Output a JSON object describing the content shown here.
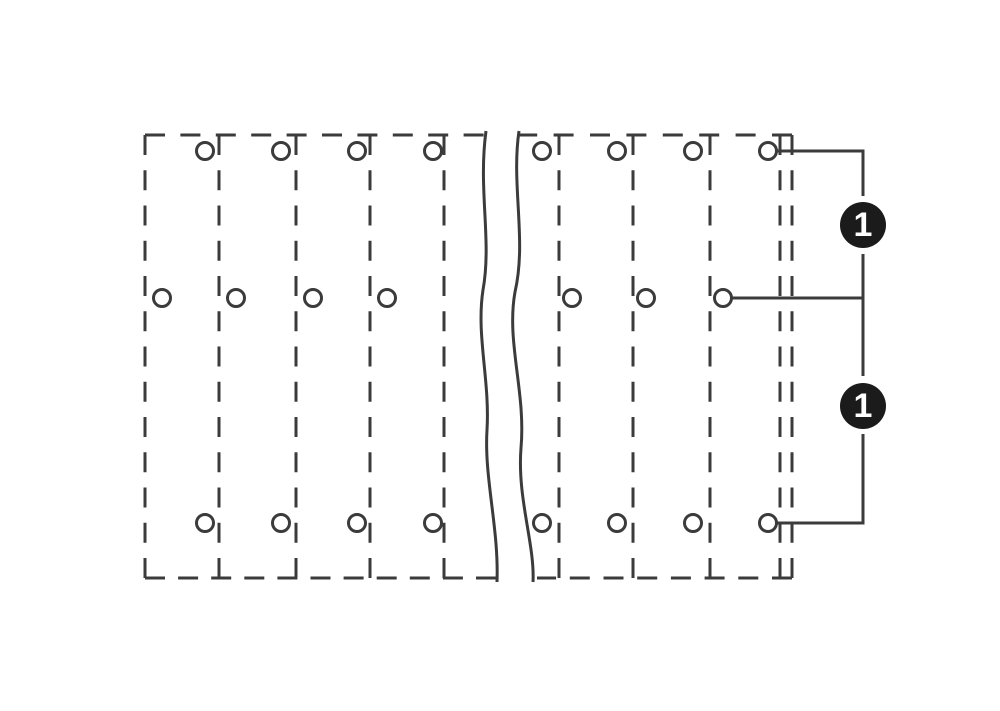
{
  "colors": {
    "background": "#ffffff",
    "line": "#3b3b3b",
    "badge_bg": "#1b1b1b",
    "badge_text": "#ffffff"
  },
  "canvas": {
    "width": 1000,
    "height": 711
  },
  "diagram": {
    "description": "Dashed-outline drilling plan of a multi-pole triple-deck terminal block with break symbol and position-1 callouts",
    "stroke_width": 3,
    "outline": {
      "left": 145,
      "top": 135,
      "right": 792,
      "bottom": 578
    },
    "edges": [
      {
        "d": "M145 135 H486",
        "dash": "20 15.4"
      },
      {
        "d": "M792 135 H519",
        "dash": "20 16.4"
      },
      {
        "d": "M145 578 H497",
        "dash": "20 13.1"
      },
      {
        "d": "M792 578 H537",
        "dash": "20 13.7"
      },
      {
        "d": "M145 135 V578",
        "dash": "20 15.25"
      },
      {
        "d": "M792 135 V578",
        "dash": "20 15.25"
      }
    ],
    "separators_x": [
      219,
      296,
      370,
      444,
      559,
      633,
      710,
      780
    ],
    "separator_dash": "20 15.25",
    "break_lines": [
      "M486 131 C478 190 492 240 483 290 C476 335 490 380 487 430 C484 478 499 528 497 582",
      "M519 131 C511 185 527 240 515 292 C506 342 526 392 521 448 C517 498 535 545 533 582"
    ],
    "holes": {
      "radius": 8.5,
      "rows": [
        {
          "name": "top",
          "y": 151,
          "xs": [
            205,
            281,
            357,
            433,
            542,
            617,
            693,
            768
          ]
        },
        {
          "name": "middle",
          "y": 298,
          "xs": [
            162,
            236,
            313,
            387,
            572,
            646,
            723
          ]
        },
        {
          "name": "bottom",
          "y": 523,
          "xs": [
            205,
            281,
            357,
            433,
            542,
            617,
            693,
            768
          ]
        }
      ]
    },
    "callout": {
      "lines": [
        "M777 151 H863 V196",
        "M863 254 V376",
        "M731 298 H863",
        "M863 434 V523 H777"
      ],
      "badge_radius": 23,
      "badges": [
        {
          "label": "1",
          "cx": 863,
          "cy": 225
        },
        {
          "label": "1",
          "cx": 863,
          "cy": 406
        }
      ]
    }
  }
}
